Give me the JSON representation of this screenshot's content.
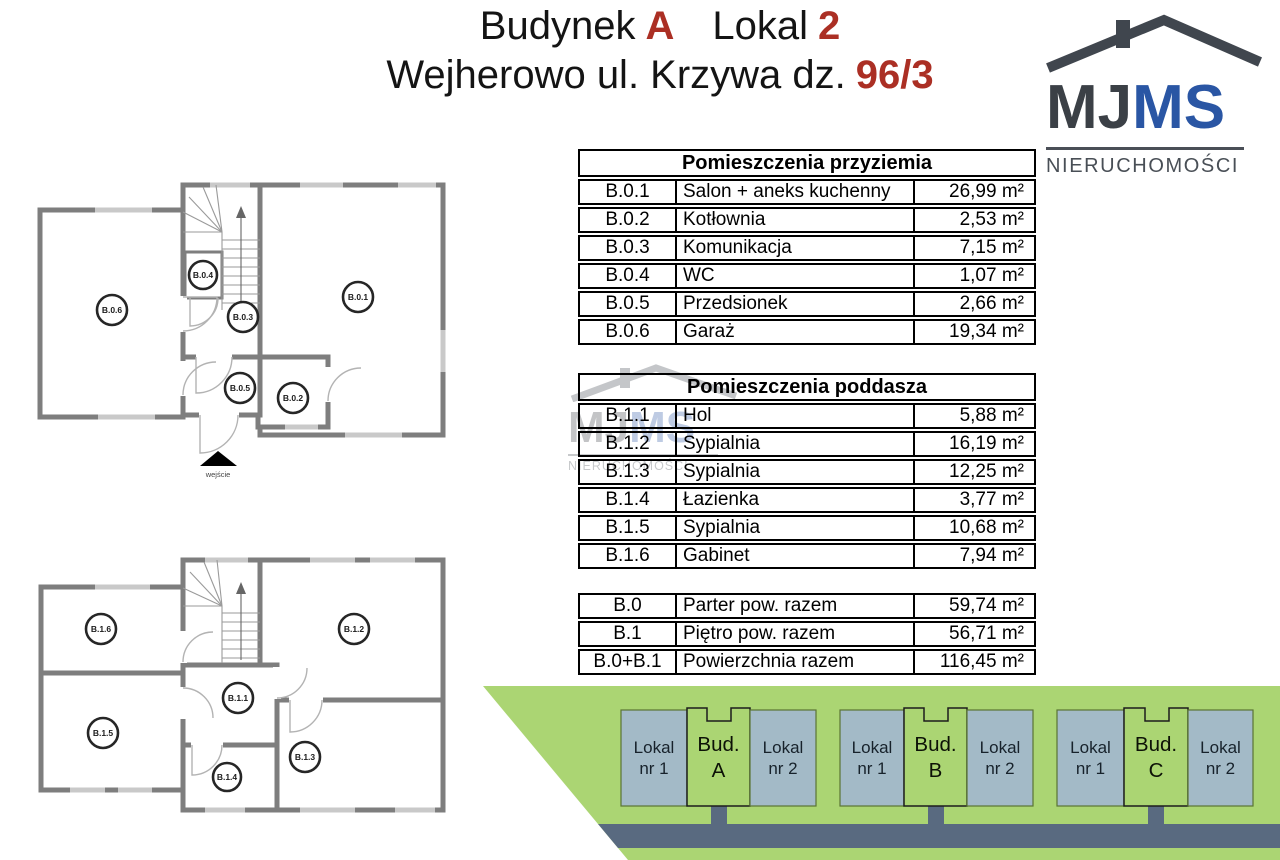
{
  "header": {
    "title_part1": "Budynek",
    "accent_building": "A",
    "title_part2": "Lokal",
    "accent_unit": "2",
    "address": "Wejherowo ul. Krzywa dz.",
    "accent_plot": "96/3"
  },
  "logo": {
    "mj": "MJ",
    "ms": "MS",
    "subtitle": "NIERUCHOMOŚCI"
  },
  "tables": {
    "ground": {
      "title": "Pomieszczenia przyziemia",
      "rows": [
        [
          "B.0.1",
          "Salon + aneks kuchenny",
          "26,99 m²"
        ],
        [
          "B.0.2",
          "Kotłownia",
          "2,53 m²"
        ],
        [
          "B.0.3",
          "Komunikacja",
          "7,15 m²"
        ],
        [
          "B.0.4",
          "WC",
          "1,07 m²"
        ],
        [
          "B.0.5",
          "Przedsionek",
          "2,66 m²"
        ],
        [
          "B.0.6",
          "Garaż",
          "19,34 m²"
        ]
      ]
    },
    "attic": {
      "title": "Pomieszczenia poddasza",
      "rows": [
        [
          "B.1.1",
          "Hol",
          "5,88 m²"
        ],
        [
          "B.1.2",
          "Sypialnia",
          "16,19 m²"
        ],
        [
          "B.1.3",
          "Sypialnia",
          "12,25 m²"
        ],
        [
          "B.1.4",
          "Łazienka",
          "3,77 m²"
        ],
        [
          "B.1.5",
          "Sypialnia",
          "10,68 m²"
        ],
        [
          "B.1.6",
          "Gabinet",
          "7,94 m²"
        ]
      ]
    },
    "summary": {
      "rows": [
        [
          "B.0",
          "Parter pow. razem",
          "59,74 m²"
        ],
        [
          "B.1",
          "Piętro pow. razem",
          "56,71 m²"
        ],
        [
          "B.0+B.1",
          "Powierzchnia razem",
          "116,45 m²"
        ]
      ]
    }
  },
  "plans": {
    "ground": {
      "labels": [
        "B.0.1",
        "B.0.2",
        "B.0.3",
        "B.0.4",
        "B.0.5",
        "B.0.6"
      ],
      "entrance_label": "wejście"
    },
    "attic": {
      "labels": [
        "B.1.1",
        "B.1.2",
        "B.1.3",
        "B.1.4",
        "B.1.5",
        "B.1.6"
      ]
    }
  },
  "site": {
    "groups": [
      {
        "unit1": "Lokal nr 1",
        "building": "Bud. A",
        "unit2": "Lokal nr 2"
      },
      {
        "unit1": "Lokal nr 1",
        "building": "Bud. B",
        "unit2": "Lokal nr 2"
      },
      {
        "unit1": "Lokal nr 1",
        "building": "Bud. C",
        "unit2": "Lokal nr 2"
      }
    ]
  },
  "colors": {
    "accent_red": "#ab2f24",
    "logo_blue": "#2a56a4",
    "logo_gray": "#3b4046",
    "site_green": "#abd573",
    "road_slate": "#596a80",
    "unit_blue": "#a3bac7",
    "wall_gray": "#7e7e7e"
  }
}
